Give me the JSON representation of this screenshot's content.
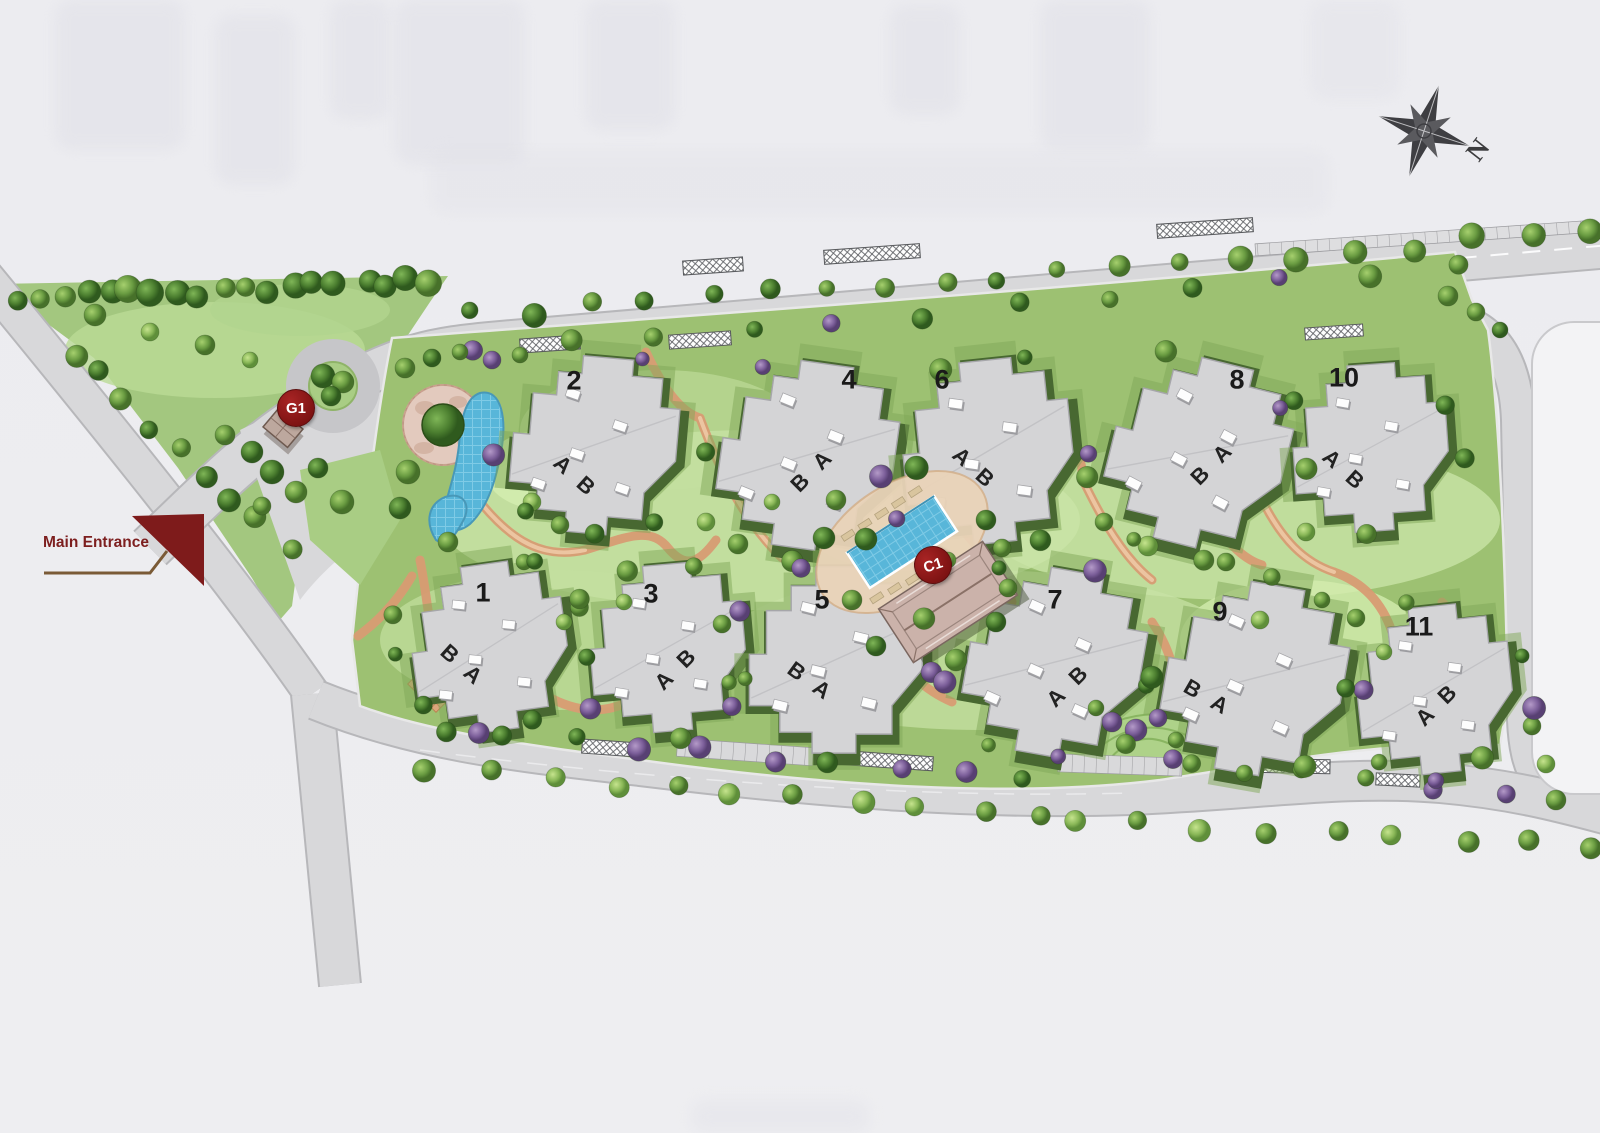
{
  "site_plan": {
    "main_entrance_label": "Main Entrance",
    "compass_north_label": "N",
    "markers": {
      "gate": "G1",
      "clubhouse": "C1"
    },
    "buildings": [
      {
        "number": "1",
        "units": "B A"
      },
      {
        "number": "2",
        "units": "A B"
      },
      {
        "number": "3",
        "units": "A B"
      },
      {
        "number": "4",
        "units": "B A"
      },
      {
        "number": "5",
        "units": "B A"
      },
      {
        "number": "6",
        "units": "A B"
      },
      {
        "number": "7",
        "units": "A B"
      },
      {
        "number": "8",
        "units": "B A"
      },
      {
        "number": "9",
        "units": "B A"
      },
      {
        "number": "10",
        "units": "A B"
      },
      {
        "number": "11",
        "units": "A B"
      }
    ],
    "colors": {
      "accent_red": "#8e1b1b",
      "road_grey": "#d8d8da",
      "building_grey": "#d4d4d6",
      "landscape_green": "#9dc172",
      "pool_blue": "#58b6d9"
    }
  }
}
